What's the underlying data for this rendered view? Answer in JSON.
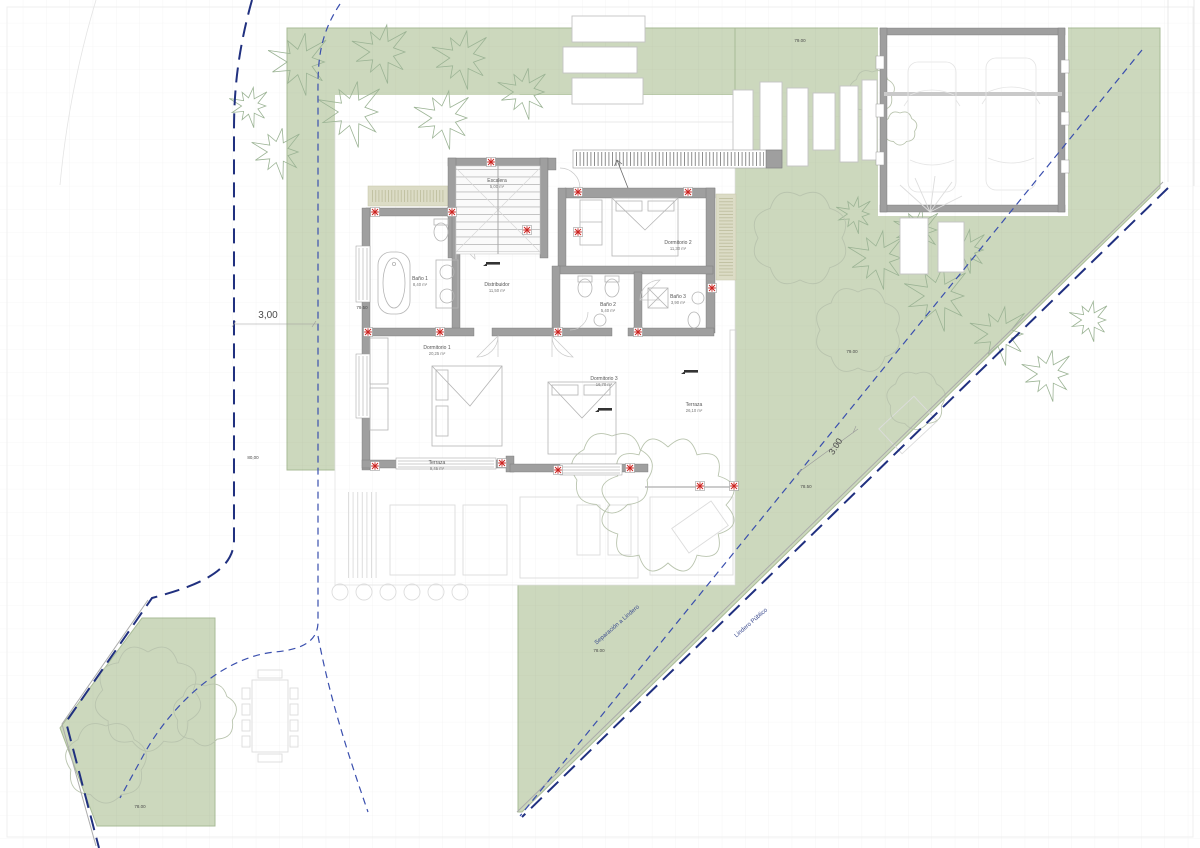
{
  "colors": {
    "green": "#ccd8bd",
    "greenDot": "#b9cba6",
    "wall": "#9f9f9f",
    "navy": "#20307f",
    "setback": "#3a4fae",
    "red": "#cc2320",
    "ghost": "#dcdcdc",
    "text": "#4a4a4a",
    "tan": "#dcdcc6"
  },
  "rooms": [
    {
      "name": "Escalera",
      "area": "5,00 m²",
      "x": 497,
      "y": 182
    },
    {
      "name": "Baño 1",
      "area": "8,40 m²",
      "x": 420,
      "y": 280
    },
    {
      "name": "Distribuidor",
      "area": "11,50 m²",
      "x": 497,
      "y": 286
    },
    {
      "name": "Dormitorio 2",
      "area": "11,30 m²",
      "x": 678,
      "y": 244
    },
    {
      "name": "Baño 2",
      "area": "5,40 m²",
      "x": 608,
      "y": 306
    },
    {
      "name": "Baño 3",
      "area": "3,90 m²",
      "x": 678,
      "y": 298
    },
    {
      "name": "Dormitorio 1",
      "area": "20,25 m²",
      "x": 437,
      "y": 349
    },
    {
      "name": "Dormitorio 3",
      "area": "16,70 m²",
      "x": 604,
      "y": 380
    },
    {
      "name": "Terraza",
      "area": "26,10 m²",
      "x": 694,
      "y": 406
    },
    {
      "name": "Terraza",
      "area": "9,45 m²",
      "x": 437,
      "y": 464
    }
  ],
  "dimensions": [
    {
      "text": "3,00",
      "x": 268,
      "y": 318,
      "rot": 0,
      "size": 10
    },
    {
      "text": "79.50",
      "x": 362,
      "y": 309,
      "rot": 0,
      "size": 4.5
    },
    {
      "text": "80,00",
      "x": 253,
      "y": 459,
      "rot": 0,
      "size": 4.5
    },
    {
      "text": "79.00",
      "x": 800,
      "y": 42,
      "rot": 0,
      "size": 4.5
    },
    {
      "text": "79.00",
      "x": 852,
      "y": 353,
      "rot": 0,
      "size": 4.5
    },
    {
      "text": "78.50",
      "x": 806,
      "y": 488,
      "rot": 0,
      "size": 4.5
    },
    {
      "text": "78.00",
      "x": 599,
      "y": 652,
      "rot": 0,
      "size": 4.5
    },
    {
      "text": "78.00",
      "x": 140,
      "y": 808,
      "rot": 0,
      "size": 4.5
    },
    {
      "text": "3.00",
      "x": 838,
      "y": 448,
      "rot": -57,
      "size": 9
    }
  ],
  "boundary_labels": [
    {
      "text": "Separación a Lindero",
      "x": 618,
      "y": 626,
      "rot": -41,
      "size": 6
    },
    {
      "text": "Lindero Público",
      "x": 752,
      "y": 624,
      "rot": -41,
      "size": 6
    }
  ],
  "icons": {
    "column_marker": "red asterisk in white square",
    "level_marker": "black spot-level tick"
  }
}
